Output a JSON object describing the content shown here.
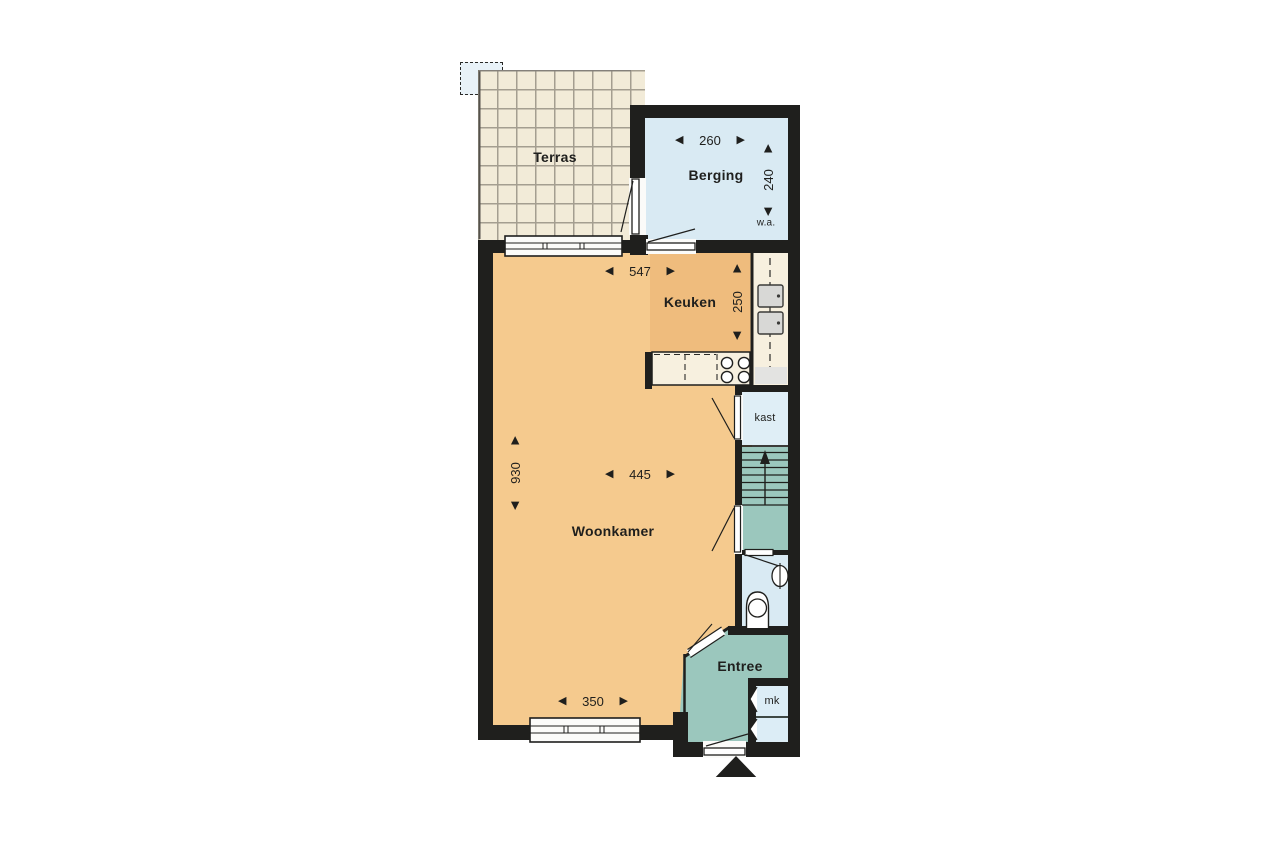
{
  "plan_title": "ground-floor-plan",
  "icons": {
    "arrow_left": "◀",
    "arrow_right": "▶"
  },
  "colors": {
    "wall": "#1f1f1d",
    "floor_living": "#f5ca8e",
    "floor_kitchen": "#efbc7d",
    "floor_storage": "#d9eaf3",
    "floor_hall": "#9bc7bd",
    "terrace_tile": "#f2ebd8",
    "terrace_grout": "#a49e90",
    "counter": "#f7f0df",
    "window": "#fbfbf9"
  },
  "rooms": {
    "terras": {
      "label": "Terras"
    },
    "berging": {
      "label": "Berging",
      "width": "260",
      "depth": "240",
      "wa": "w.a."
    },
    "keuken": {
      "label": "Keuken",
      "width": "547",
      "depth": "250"
    },
    "woonkamer": {
      "label": "Woonkamer",
      "width": "445",
      "depth": "930",
      "window_width": "350"
    },
    "kast": {
      "label": "kast"
    },
    "entree": {
      "label": "Entree",
      "mk": "mk"
    }
  }
}
